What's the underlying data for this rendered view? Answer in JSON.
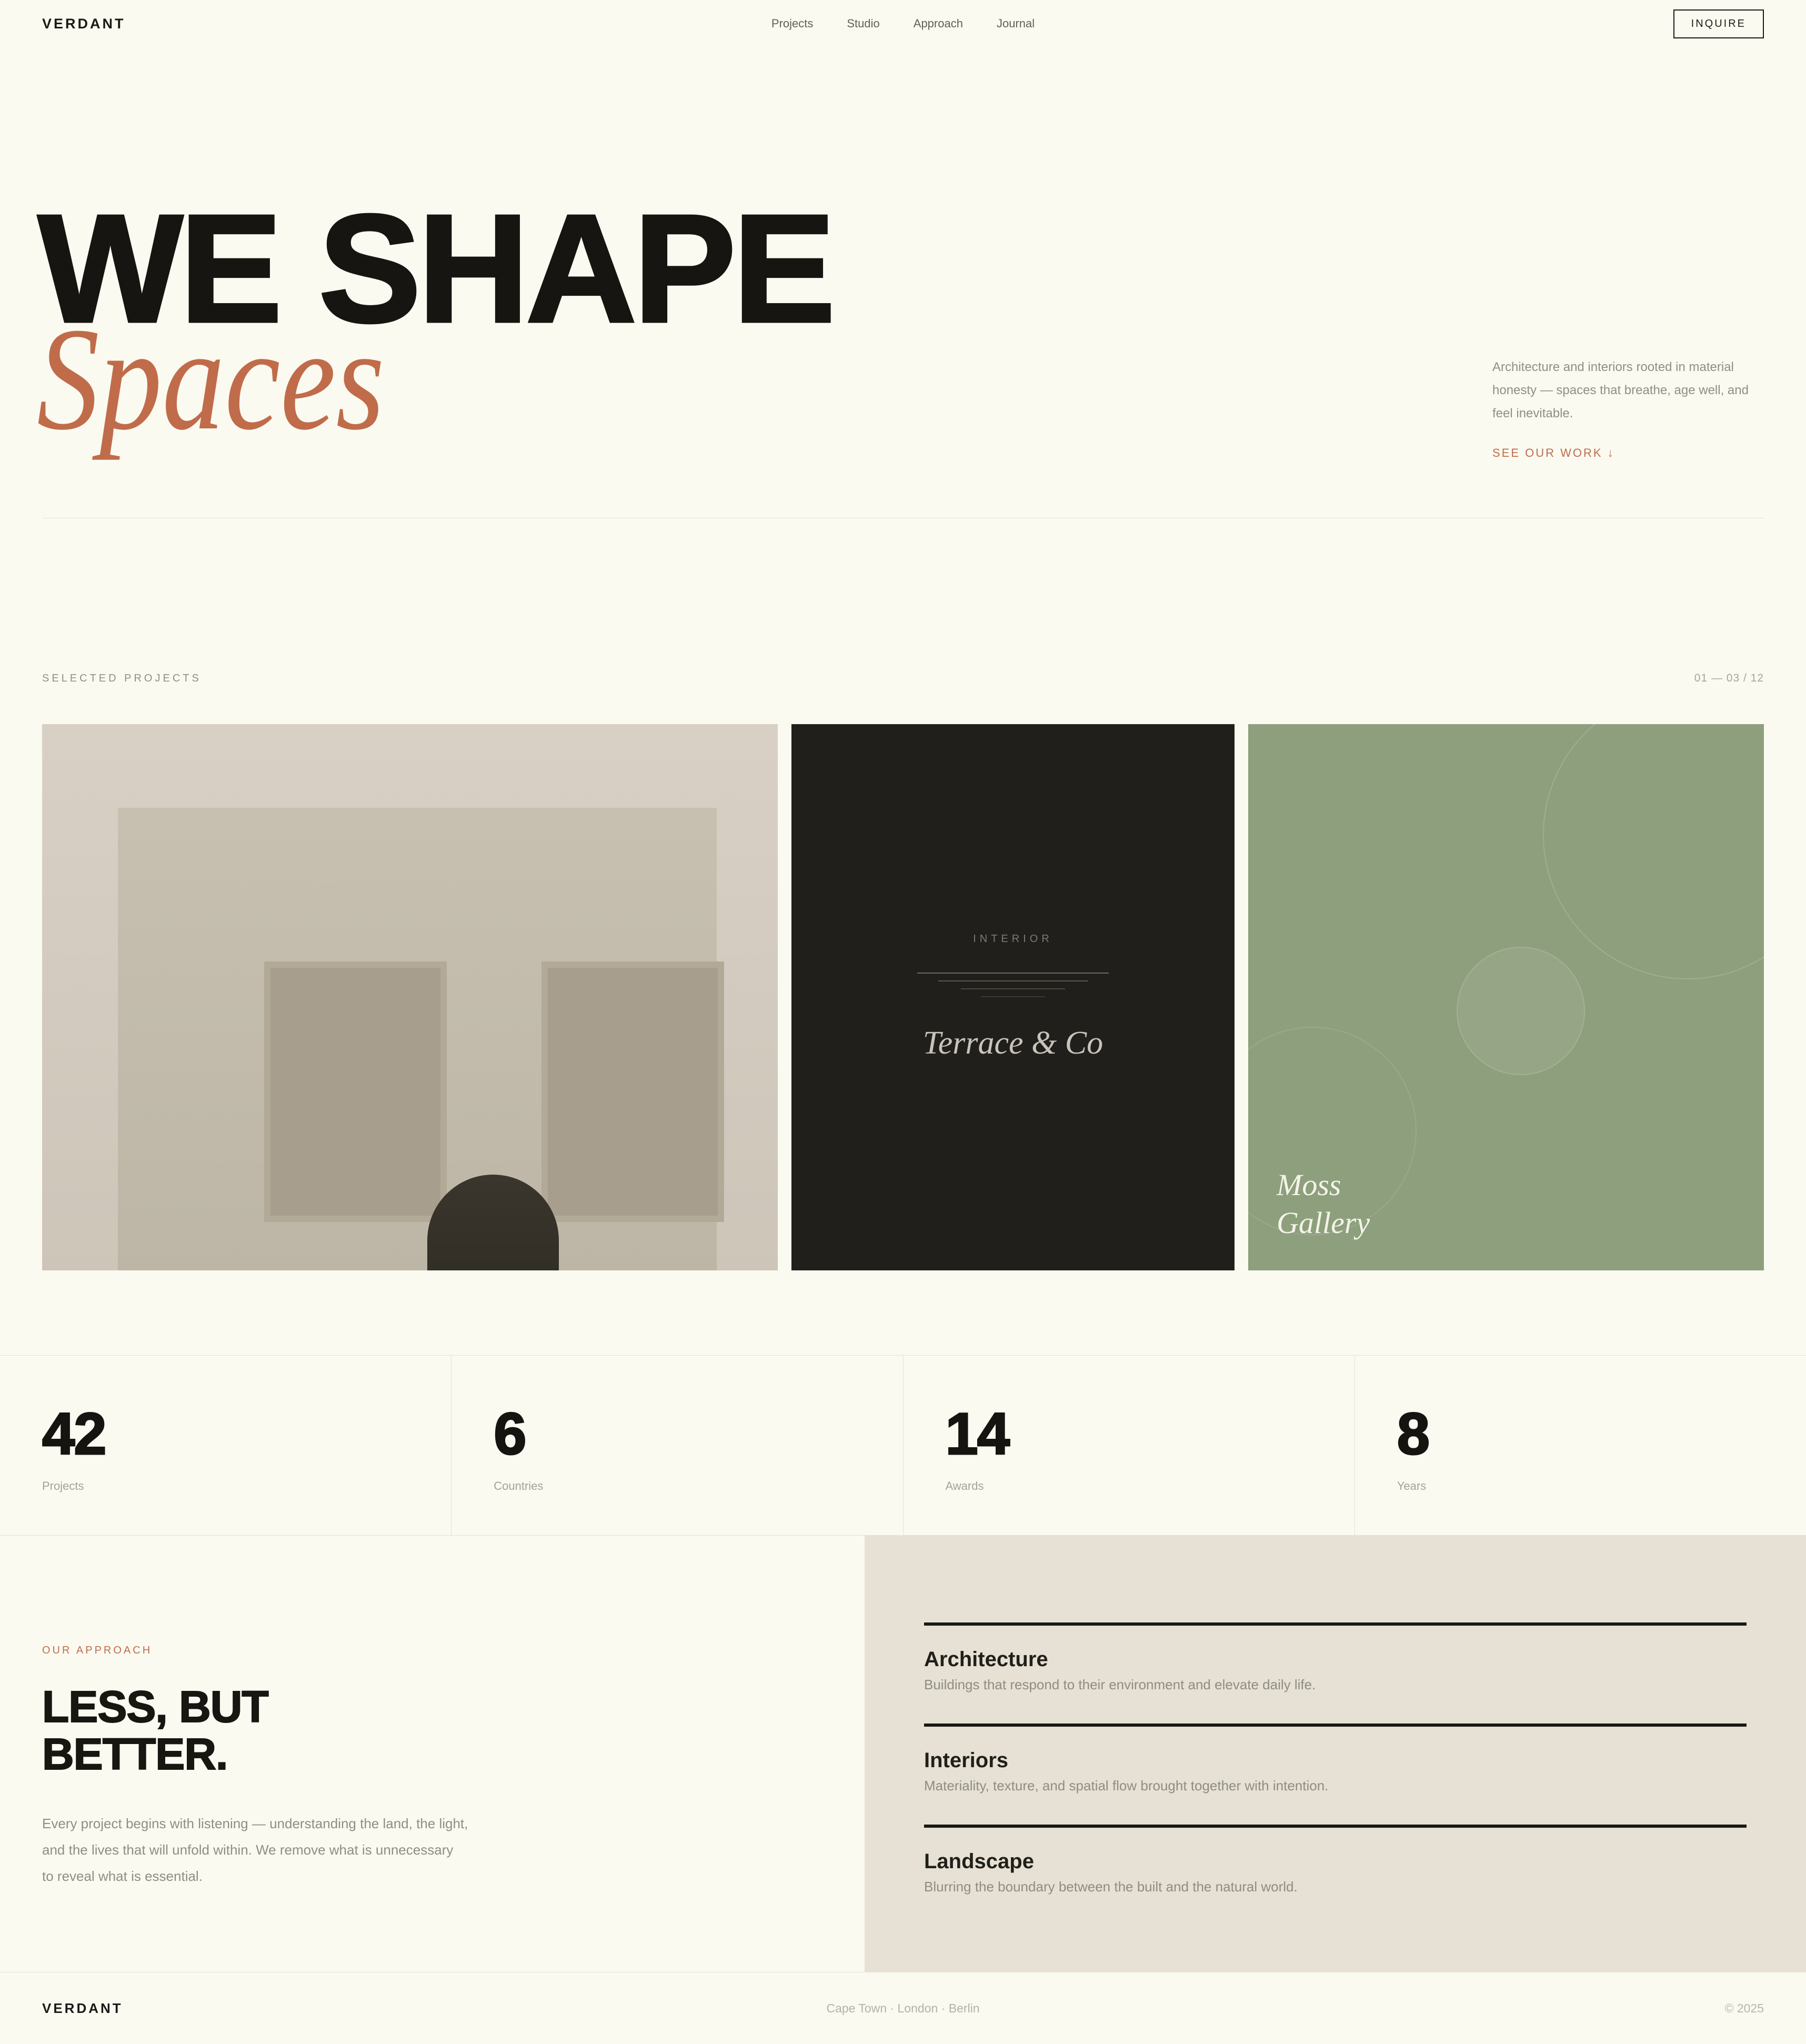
{
  "brand": "VERDANT",
  "header": {
    "nav": [
      {
        "label": "Projects"
      },
      {
        "label": "Studio"
      },
      {
        "label": "Approach"
      },
      {
        "label": "Journal"
      }
    ],
    "inquire_label": "INQUIRE"
  },
  "hero": {
    "title_line1": "WE SHAPE",
    "title_line2": "Spaces",
    "description": "Architecture and interiors rooted in material honesty — spaces that breathe, age well, and feel inevitable.",
    "cta": "SEE OUR WORK ↓"
  },
  "projects": {
    "section_label": "SELECTED PROJECTS",
    "counter": "01 — 03 / 12",
    "cards": [
      {
        "name": "facade-illustration"
      },
      {
        "category": "INTERIOR",
        "title": "Terrace & Co"
      },
      {
        "title_line1": "Moss",
        "title_line2": "Gallery"
      }
    ]
  },
  "stats": [
    {
      "value": "42",
      "label": "Projects"
    },
    {
      "value": "6",
      "label": "Countries"
    },
    {
      "value": "14",
      "label": "Awards"
    },
    {
      "value": "8",
      "label": "Years"
    }
  ],
  "approach": {
    "eyebrow": "OUR APPROACH",
    "heading_line1": "LESS, BUT",
    "heading_line2": "BETTER.",
    "body": "Every project begins with listening — understanding the land, the light, and the lives that will unfold within. We remove what is unnecessary to reveal what is essential.",
    "services": [
      {
        "title": "Architecture",
        "description": "Buildings that respond to their environment and elevate daily life."
      },
      {
        "title": "Interiors",
        "description": "Materiality, texture, and spatial flow brought together with intention."
      },
      {
        "title": "Landscape",
        "description": "Blurring the boundary between the built and the natural world."
      }
    ]
  },
  "footer": {
    "brand": "VERDANT",
    "locations": "Cape Town · London · Berlin",
    "copyright": "© 2025"
  },
  "colors": {
    "background": "#fafaf1",
    "ink": "#161511",
    "terracotta": "#c06c4a",
    "muted_gray": "#8f8f88",
    "card_dark": "#211f1b",
    "card_green": "#8d9f7d",
    "card_beige": "#d3cbc0",
    "panel_beige": "#e6e1d4"
  }
}
